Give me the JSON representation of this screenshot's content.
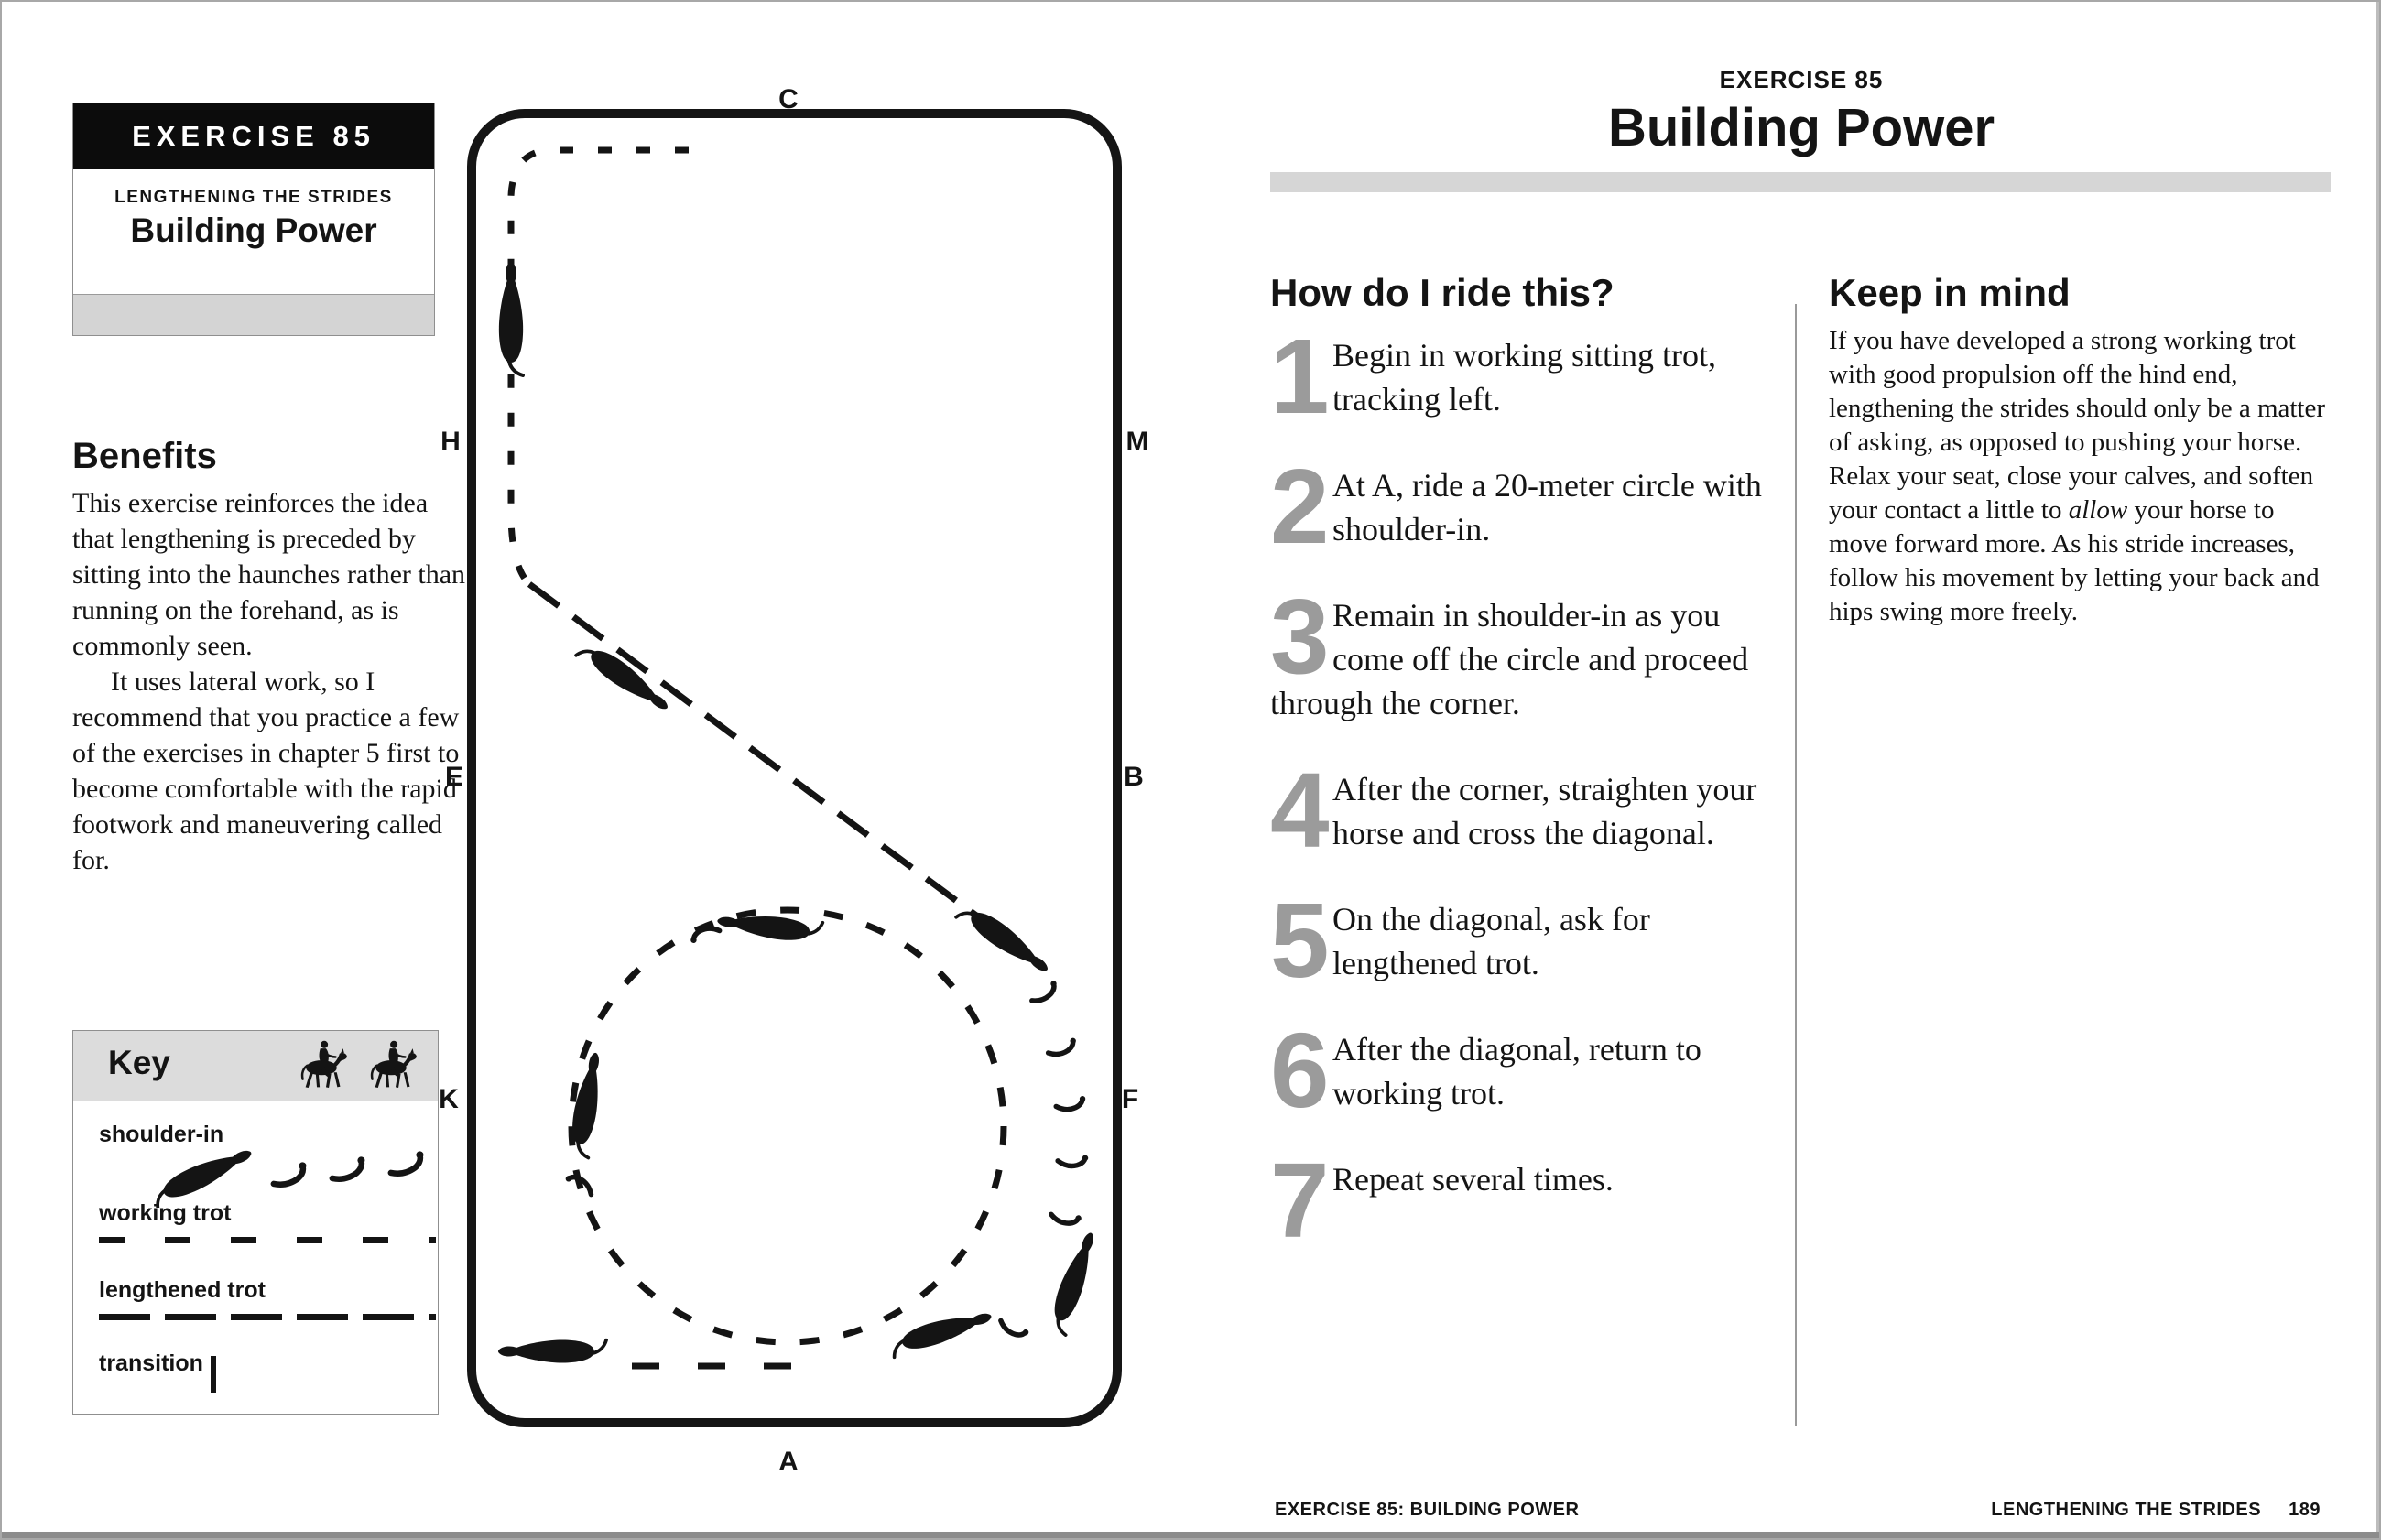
{
  "left": {
    "header": {
      "exercise_label": "EXERCISE 85",
      "series": "LENGTHENING THE STRIDES",
      "title": "Building Power"
    },
    "benefits": {
      "heading": "Benefits",
      "para1": "This exercise reinforces the idea that lengthening is preceded by sitting into the haunches rather than running on the forehand, as is commonly seen.",
      "para2": "It uses lateral work, so I recommend that you practice a few of the exercises in chapter 5 first to become comfortable with the rapid footwork and maneuvering called for."
    },
    "key": {
      "title": "Key",
      "items": [
        {
          "label": "shoulder-in"
        },
        {
          "label": "working trot"
        },
        {
          "label": "lengthened trot"
        },
        {
          "label": "transition"
        }
      ]
    }
  },
  "arena": {
    "letters": {
      "C": "C",
      "H": "H",
      "E": "E",
      "K": "K",
      "A": "A",
      "F": "F",
      "B": "B",
      "M": "M"
    }
  },
  "right": {
    "header": {
      "exercise_label": "EXERCISE 85",
      "title": "Building Power"
    },
    "how": {
      "heading": "How do I ride this?",
      "steps": [
        {
          "num": "1",
          "text": "Begin in working sitting trot, tracking left."
        },
        {
          "num": "2",
          "text": "At A, ride a 20-meter circle with shoulder-in."
        },
        {
          "num": "3",
          "text": "Remain in shoulder-in as you come off the circle and proceed through the corner."
        },
        {
          "num": "4",
          "text": "After the corner, straighten your horse and cross the diagonal."
        },
        {
          "num": "5",
          "text": "On the diagonal, ask for lengthened trot."
        },
        {
          "num": "6",
          "text": "After the diagonal, return to working trot."
        },
        {
          "num": "7",
          "text": "Repeat several times."
        }
      ]
    },
    "keep": {
      "heading": "Keep in mind",
      "body_before": "If you have developed a strong working trot with good propulsion off the hind end, lengthening the strides should only be a matter of asking, as opposed to pushing your horse. Relax your seat, close your calves, and soften your contact a little to ",
      "body_italic": "allow",
      "body_after": " your horse to move forward more. As his stride increases, follow his movement by letting your back and hips swing more freely."
    }
  },
  "footer": {
    "left": "EXERCISE 85: BUILDING POWER",
    "right_label": "LENGTHENING THE STRIDES",
    "page_number": "189"
  },
  "colors": {
    "ink": "#141414",
    "numeral_gray": "#9b9b9b",
    "bar_gray": "#d6d6d6",
    "key_header_gray": "#dcdcdc",
    "border_gray": "#8f8f8f"
  }
}
